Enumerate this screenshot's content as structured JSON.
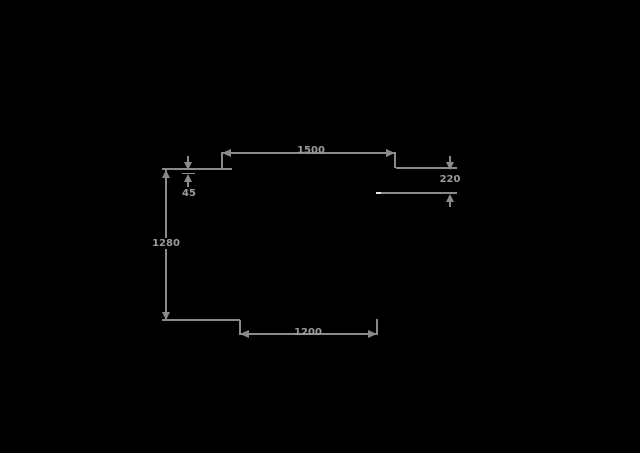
{
  "drawing": {
    "type": "dimensioned technical drawing",
    "background_color": "#000000",
    "line_color": "#8a8a8a",
    "text_color": "#9b9b9b",
    "accent_white": "#e6e6e6",
    "dimensions": {
      "top_width": "1500",
      "bottom_width": "1200",
      "left_height": "1280",
      "right_offset": "220",
      "top_left_thickness": "45"
    }
  }
}
